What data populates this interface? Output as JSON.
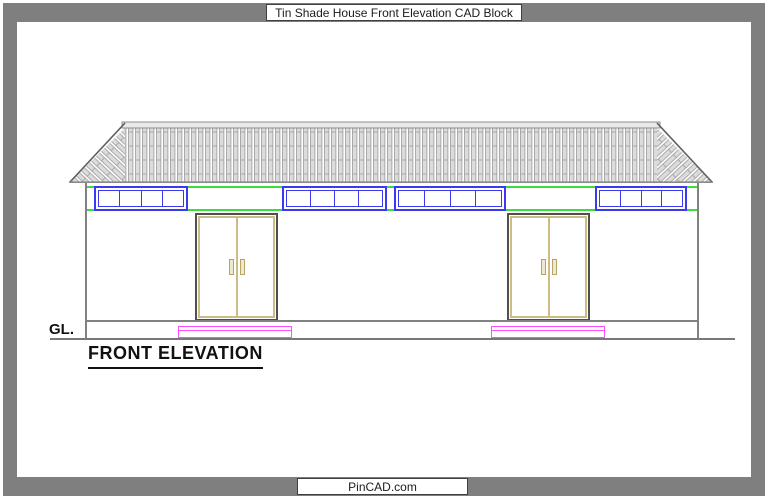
{
  "page": {
    "header_title": "Tin Shade House Front Elevation CAD Block",
    "footer_brand": "PinCAD.com"
  },
  "drawing": {
    "caption": "FRONT ELEVATION",
    "ground_line_label": "GL.",
    "components": {
      "roof": "corrugated tin roof with hipped ends and ridge cap",
      "windows": [
        "4-pane strip window",
        "4-pane strip window",
        "4-pane strip window",
        "4-pane strip window"
      ],
      "doors": [
        "double-leaf door with handles",
        "double-leaf door with handles"
      ],
      "steps": [
        "entry step",
        "entry step"
      ]
    },
    "colors": {
      "frame_gray": "#7f7f7f",
      "outline_gray": "#818181",
      "window_blue": "#3a3af2",
      "lintel_green": "#3ddc3d",
      "step_magenta": "#ff4cff",
      "door_wood_tan": "#cdbd85",
      "door_frame_dark": "#4f4f4f",
      "roof_stripe_fill": "#dcdcdc"
    }
  }
}
